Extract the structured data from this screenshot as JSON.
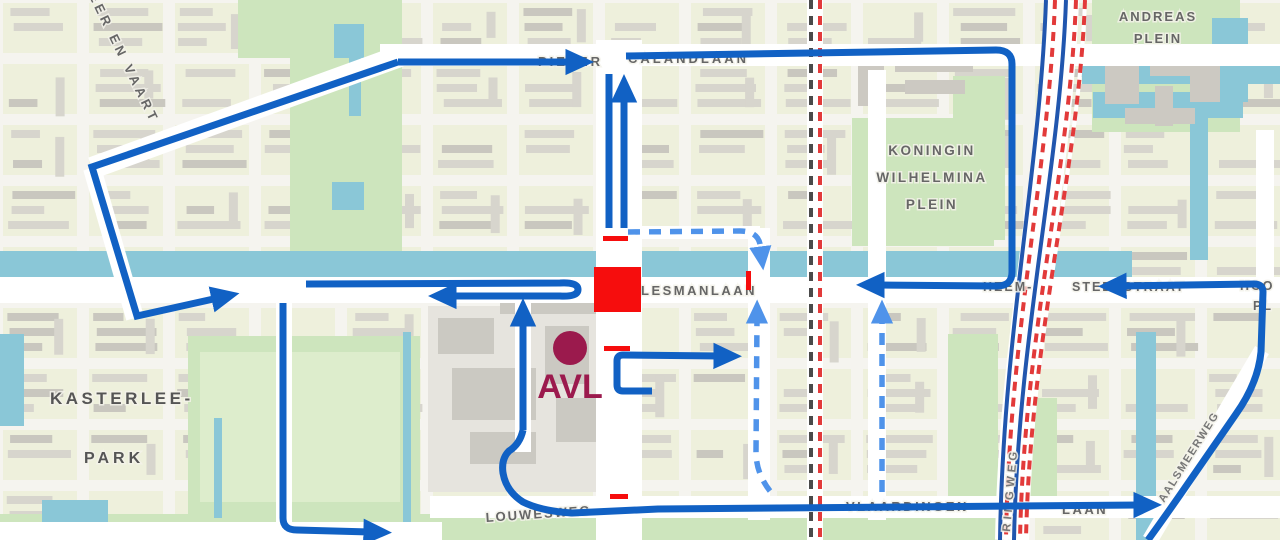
{
  "map": {
    "colors": {
      "bg": "#f5f4ef",
      "block": "#eef0dc",
      "building": "#d7d5cd",
      "building_dark": "#c9c7bf",
      "park": "#cde5bd",
      "park_light": "#ddedcc",
      "water": "#8ac7d7",
      "road": "#ffffff",
      "label": "#666666",
      "label_dark": "#555555",
      "rail_red": "#e23a3a",
      "rail_dark": "#4a4a4a",
      "rail_blue": "#2156ae",
      "route_solid": "#1161c4",
      "route_dashed": "#4f93ea",
      "closure": "#f60d0d",
      "avl": "#9b1a4d"
    },
    "street_labels": [
      {
        "id": "label-pieter",
        "text": "PIETER",
        "x": 538,
        "y": 66,
        "size": 13,
        "ls": 3,
        "anchor": "start"
      },
      {
        "id": "label-calandlaan",
        "text": "CALANDLAAN",
        "x": 628,
        "y": 63,
        "size": 13,
        "ls": 3,
        "anchor": "start"
      },
      {
        "id": "label-meer-en-vaart",
        "text": "MEER EN VAART",
        "x": 82,
        "y": -18,
        "size": 13,
        "ls": 4,
        "anchor": "start",
        "rot": 64
      },
      {
        "id": "label-koningin",
        "text": "KONINGIN",
        "x": 932,
        "y": 155,
        "size": 13.5,
        "ls": 2.5,
        "anchor": "middle"
      },
      {
        "id": "label-wilhelmina",
        "text": "WILHELMINA",
        "x": 932,
        "y": 182,
        "size": 13.5,
        "ls": 2.5,
        "anchor": "middle"
      },
      {
        "id": "label-kw-plein",
        "text": "PLEIN",
        "x": 932,
        "y": 209,
        "size": 13.5,
        "ls": 2.5,
        "anchor": "middle"
      },
      {
        "id": "label-andreas",
        "text": "ANDREAS",
        "x": 1158,
        "y": 21,
        "size": 13,
        "ls": 2,
        "anchor": "middle"
      },
      {
        "id": "label-andreas-plein",
        "text": "PLEIN",
        "x": 1158,
        "y": 43,
        "size": 13,
        "ls": 2,
        "anchor": "middle"
      },
      {
        "id": "label-kasterlee",
        "text": "KASTERLEE-",
        "x": 50,
        "y": 404,
        "size": 17,
        "ls": 3.5,
        "anchor": "start",
        "color": "#555555"
      },
      {
        "id": "label-park",
        "text": "PARK",
        "x": 84,
        "y": 463,
        "size": 16,
        "ls": 4,
        "anchor": "start",
        "color": "#555555"
      },
      {
        "id": "label-lesmanlaan",
        "text": "LESMANLAAN",
        "x": 641,
        "y": 295,
        "size": 13,
        "ls": 2.5,
        "anchor": "start"
      },
      {
        "id": "label-heem",
        "text": "HEEM-",
        "x": 983,
        "y": 291,
        "size": 12.5,
        "ls": 2,
        "anchor": "start"
      },
      {
        "id": "label-stedestraat",
        "text": "STEDESTRAAT",
        "x": 1072,
        "y": 291,
        "size": 12.5,
        "ls": 2,
        "anchor": "start"
      },
      {
        "id": "label-hoo",
        "text": "HOO",
        "x": 1240,
        "y": 290,
        "size": 12.5,
        "ls": 2,
        "anchor": "start"
      },
      {
        "id": "label-pl",
        "text": "PL",
        "x": 1253,
        "y": 310,
        "size": 12.5,
        "ls": 2,
        "anchor": "start"
      },
      {
        "id": "label-vlaardingen",
        "text": "VLAARDINGEN",
        "x": 846,
        "y": 511,
        "size": 13,
        "ls": 2.5,
        "anchor": "start"
      },
      {
        "id": "label-laan",
        "text": "LAAN",
        "x": 1062,
        "y": 514,
        "size": 13,
        "ls": 2.5,
        "anchor": "start"
      },
      {
        "id": "label-louwesweg",
        "text": "LOUWESWEG",
        "x": 486,
        "y": 522,
        "size": 13,
        "ls": 2,
        "anchor": "start",
        "rot": -4
      },
      {
        "id": "label-ringweg",
        "text": "RINGWEG",
        "x": 1010,
        "y": 532,
        "size": 11.5,
        "ls": 4,
        "anchor": "start",
        "rot": -85,
        "color": "#777777"
      },
      {
        "id": "label-aalsmeerweg",
        "text": "AALSMEERWEG",
        "x": 1164,
        "y": 503,
        "size": 11,
        "ls": 1.5,
        "anchor": "start",
        "rot": -58,
        "color": "#777777"
      }
    ],
    "poi": {
      "label": "AVL",
      "circle": {
        "cx": 570,
        "cy": 348,
        "r": 17
      },
      "label_x": 570,
      "label_y": 398,
      "size": 34
    },
    "routes": {
      "solid": [
        {
          "name": "route-meer-en-vaart-loop",
          "d": "M398,62 L92,167 L137,316 L218,298"
        },
        {
          "name": "route-calandlaan-west",
          "d": "M398,62 L572,62"
        },
        {
          "name": "route-calandlaan-east-wilhelmina",
          "d": "M626,56 L996,50 Q1012,50 1012,64 L1012,272 Q1012,286 997,286 L878,285"
        },
        {
          "name": "route-plesmanlaan-uturn",
          "d": "M306,284 L560,283 Q578,282 578,289.5 Q578,297 560,296 L450,296"
        },
        {
          "name": "route-avl-north",
          "d": "M523,430 L523,320"
        },
        {
          "name": "route-louwesweg-vlaardingenlaan",
          "d": "M523,430 Q520,444 509,451 Q501,459 503,473 Q506,491 523,502 Q541,511 572,513 L658,509 L1140,505"
        },
        {
          "name": "route-kasterlee",
          "d": "M283,303 L283,518 Q283,530 297,530 L370,532"
        },
        {
          "name": "route-central-north-a",
          "d": "M609,74 L609,228",
          "no_arrow": true
        },
        {
          "name": "route-central-north-b",
          "d": "M624,228 L624,96"
        },
        {
          "name": "route-avl-exit-east",
          "d": "M652,391 L623,391 Q617,391 617,385 L617,361 Q617,355 623,355 L720,356"
        },
        {
          "name": "route-heemstedestraat-aalsmeerweg",
          "d": "M1148,540 Q1164,518 1180,495 L1236,414 Q1258,383 1261,352 L1263,292 Q1263,284 1254,284 L1120,286"
        }
      ],
      "dashed": [
        {
          "name": "route-dashed-north-down",
          "d": "M628,232 L740,231 Q757,231 760,244 L761,252"
        },
        {
          "name": "route-dashed-mid-up",
          "d": "M770,491 Q756,473 756,452 L757,318"
        },
        {
          "name": "route-dashed-east-up",
          "d": "M882,492 L882,318"
        }
      ]
    },
    "closures": [
      {
        "name": "closure-square",
        "x": 594,
        "y": 267,
        "w": 47,
        "h": 45
      },
      {
        "name": "closure-tick-north",
        "x": 603,
        "y": 236,
        "w": 25,
        "h": 5
      },
      {
        "name": "closure-tick-avl",
        "x": 604,
        "y": 346,
        "w": 26,
        "h": 5
      },
      {
        "name": "closure-tick-east",
        "x": 746,
        "y": 271,
        "w": 5,
        "h": 19
      },
      {
        "name": "closure-tick-louwesweg",
        "x": 610,
        "y": 494,
        "w": 18,
        "h": 5
      }
    ]
  }
}
